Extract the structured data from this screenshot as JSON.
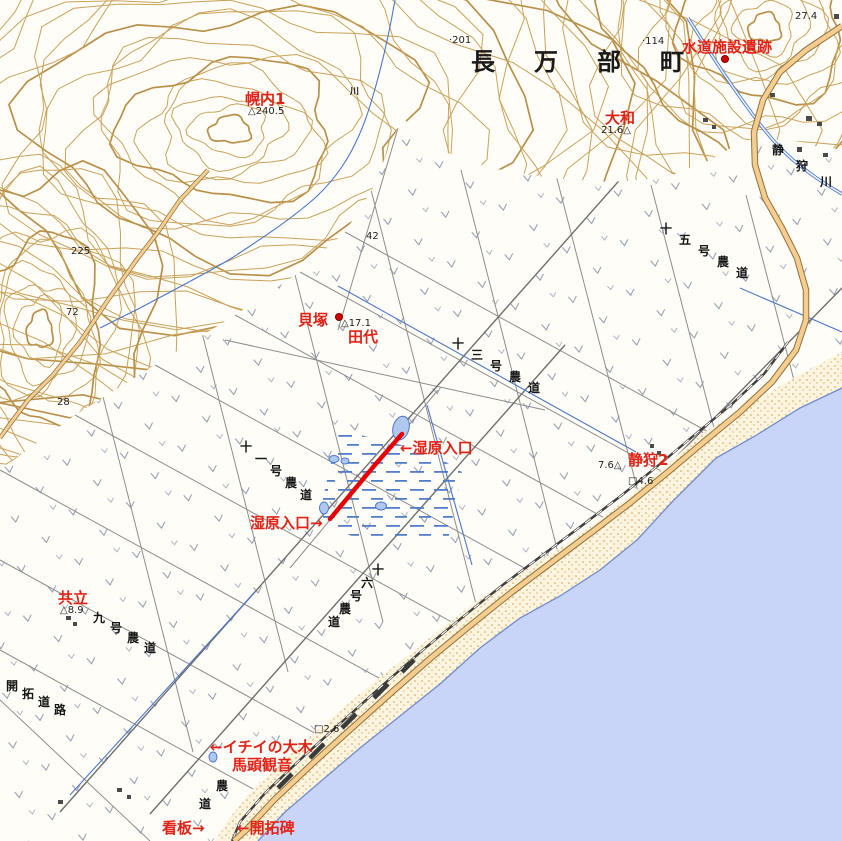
{
  "map_title": "長万部町 静狩 地形図",
  "colors": {
    "sea": "#c9d5f8",
    "coast_line": "#6f8cd0",
    "contour": "#c9a25a",
    "highway_fill": "#f6cd8e",
    "highway_casing": "#8a7340",
    "label_red": "#e02318",
    "route_red": "#e60000",
    "water": "#4a78c8"
  },
  "labels": [
    {
      "name": "label-suido-shisetsu-iseki",
      "text": "水道施設遺跡",
      "x": 682,
      "y": 40,
      "cls": "red"
    },
    {
      "name": "label-horonai-1",
      "text": "幌内1",
      "x": 245,
      "y": 92,
      "cls": "red"
    },
    {
      "name": "label-yamato",
      "text": "大和",
      "x": 605,
      "y": 111,
      "cls": "red"
    },
    {
      "name": "label-kaizuka",
      "text": "貝塚",
      "x": 298,
      "y": 313,
      "cls": "red"
    },
    {
      "name": "label-tashiro",
      "text": "田代",
      "x": 348,
      "y": 330,
      "cls": "red"
    },
    {
      "name": "label-shitsugen-iriguchi-upper",
      "text": "←湿原入口",
      "x": 400,
      "y": 441,
      "cls": "red"
    },
    {
      "name": "label-shitsugen-iriguchi-lower",
      "text": "湿原入口→",
      "x": 250,
      "y": 516,
      "cls": "red"
    },
    {
      "name": "label-shizukari-2",
      "text": "静狩2",
      "x": 628,
      "y": 453,
      "cls": "red"
    },
    {
      "name": "label-kyoritsu",
      "text": "共立",
      "x": 58,
      "y": 591,
      "cls": "red"
    },
    {
      "name": "label-ichii-no-taiboku",
      "text": "←イチイの大木",
      "x": 210,
      "y": 740,
      "cls": "red"
    },
    {
      "name": "label-batou-kannon",
      "text": "馬頭観音",
      "x": 232,
      "y": 758,
      "cls": "red"
    },
    {
      "name": "label-kanban",
      "text": "看板→",
      "x": 162,
      "y": 821,
      "cls": "red"
    },
    {
      "name": "label-kaitakuhi",
      "text": "←開拓碑",
      "x": 237,
      "y": 821,
      "cls": "red"
    },
    {
      "name": "label-oshamambe-cho",
      "text": "長万部町",
      "x": 471,
      "y": 50,
      "cls": "town",
      "char_dx": 63,
      "char_dy": 0
    },
    {
      "name": "label-shizukari-gawa",
      "text": "静狩川",
      "x": 772,
      "y": 144,
      "cls": "road",
      "char_dx": 24,
      "char_dy": 16
    },
    {
      "name": "label-juugo-gou-noudou",
      "text": "十五号農道",
      "x": 660,
      "y": 223,
      "cls": "road",
      "char_dx": 19,
      "char_dy": 11
    },
    {
      "name": "label-juusan-gou-noudou",
      "text": "十三号農道",
      "x": 452,
      "y": 338,
      "cls": "road",
      "char_dx": 19,
      "char_dy": 11
    },
    {
      "name": "label-juuichi-gou-noudou",
      "text": "十一号農道",
      "x": 240,
      "y": 441,
      "cls": "road",
      "char_dx": 15,
      "char_dy": 12
    },
    {
      "name": "label-juuroku-gou-noudou",
      "text": "十六号農道",
      "x": 372,
      "y": 564,
      "cls": "road",
      "char_dx": -11,
      "char_dy": 13
    },
    {
      "name": "label-kyuu-gou-noudou",
      "text": "九号農道",
      "x": 93,
      "y": 612,
      "cls": "road",
      "char_dx": 17,
      "char_dy": 10
    },
    {
      "name": "label-kaitaku-douro",
      "text": "開拓道路",
      "x": 6,
      "y": 680,
      "cls": "road",
      "char_dx": 16,
      "char_dy": 8
    },
    {
      "name": "label-noudou-partial",
      "text": "農道",
      "x": 216,
      "y": 780,
      "cls": "road",
      "char_dx": -17,
      "char_dy": 18
    },
    {
      "name": "label-kawa",
      "text": "川",
      "x": 350,
      "y": 88,
      "cls": "road-small"
    },
    {
      "name": "elev-27-4",
      "text": "27.4",
      "x": 795,
      "y": 12,
      "cls": "elev"
    },
    {
      "name": "elev-201",
      "text": "·201",
      "x": 449,
      "y": 36,
      "cls": "elev"
    },
    {
      "name": "elev-114",
      "text": "·114",
      "x": 642,
      "y": 37,
      "cls": "elev"
    },
    {
      "name": "elev-240-5",
      "text": "△240.5",
      "x": 248,
      "y": 107,
      "cls": "elev"
    },
    {
      "name": "elev-21-6",
      "text": "21.6△",
      "x": 601,
      "y": 126,
      "cls": "elev"
    },
    {
      "name": "elev-17-1",
      "text": "△17.1",
      "x": 341,
      "y": 319,
      "cls": "elev"
    },
    {
      "name": "elev-7-6",
      "text": "7.6△",
      "x": 598,
      "y": 461,
      "cls": "elev"
    },
    {
      "name": "elev-4-6",
      "text": "□4.6",
      "x": 628,
      "y": 477,
      "cls": "elev"
    },
    {
      "name": "elev-8-9",
      "text": "△8.9",
      "x": 60,
      "y": 606,
      "cls": "elev"
    },
    {
      "name": "elev-225",
      "text": "225",
      "x": 71,
      "y": 247,
      "cls": "elev"
    },
    {
      "name": "elev-72",
      "text": "72",
      "x": 66,
      "y": 308,
      "cls": "elev"
    },
    {
      "name": "elev-28",
      "text": "28",
      "x": 57,
      "y": 398,
      "cls": "elev"
    },
    {
      "name": "elev-42",
      "text": "42",
      "x": 366,
      "y": 232,
      "cls": "elev"
    },
    {
      "name": "elev-2-6",
      "text": "□2.6",
      "x": 314,
      "y": 725,
      "cls": "elev"
    }
  ],
  "markers": [
    {
      "name": "marker-suido-site",
      "x": 724,
      "y": 58
    },
    {
      "name": "marker-kaizuka",
      "x": 338,
      "y": 316
    }
  ],
  "route": {
    "name": "wetland-access-route",
    "color": "#e60000",
    "points": "402,434 374,466 330,519"
  }
}
